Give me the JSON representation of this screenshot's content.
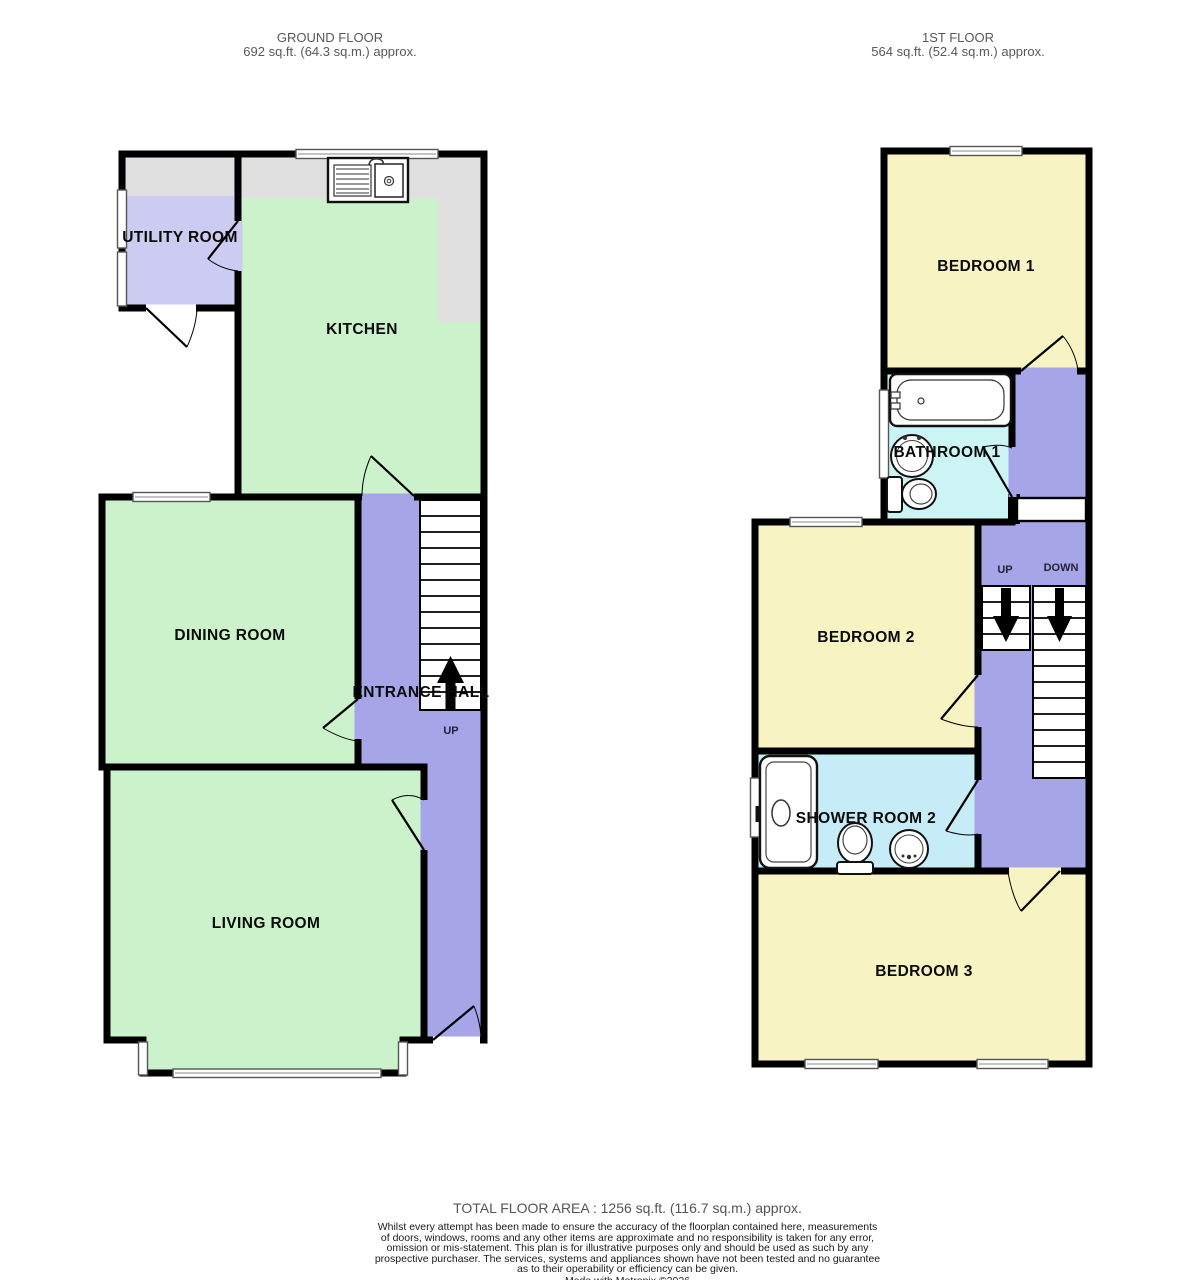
{
  "ground_floor": {
    "title": "GROUND FLOOR",
    "area": "692 sq.ft. (64.3 sq.m.) approx.",
    "rooms": {
      "utility": "UTILITY ROOM",
      "kitchen": "KITCHEN",
      "dining": "DINING ROOM",
      "entrance_hall": "ENTRANCE HALL",
      "living": "LIVING ROOM",
      "stairs_up": "UP"
    }
  },
  "first_floor": {
    "title": "1ST FLOOR",
    "area": "564 sq.ft. (52.4 sq.m.) approx.",
    "rooms": {
      "bedroom1": "BEDROOM 1",
      "bathroom1": "BATHROOM 1",
      "bedroom2": "BEDROOM 2",
      "shower_room2": "SHOWER ROOM 2",
      "bedroom3": "BEDROOM 3",
      "stairs_up": "UP",
      "stairs_down": "DOWN"
    }
  },
  "footer": {
    "total": "TOTAL FLOOR AREA : 1256 sq.ft. (116.7 sq.m.) approx.",
    "disclaimer_lines": [
      "Whilst every attempt has been made to ensure the accuracy of the floorplan contained here, measurements",
      "of doors, windows, rooms and any other items are approximate and no responsibility is taken for any error,",
      "omission or mis-statement. This plan is for illustrative purposes only and should be used as such by any",
      "prospective purchaser. The services, systems and appliances shown have not been tested and no guarantee",
      "as to their operability or efficiency can be given."
    ],
    "credit": "Made with Metropix ©2026"
  },
  "colors": {
    "wall": "#000000",
    "room_green": "#ccf2cc",
    "room_yellow": "#f7f3c3",
    "hall_lavender": "#a5a5e8",
    "utility_lavender": "#ccccf2",
    "bathroom_cyan": "#cdf4f4",
    "shower_cyan": "#c6ecf8",
    "counter_gray": "#e0e0e0"
  }
}
